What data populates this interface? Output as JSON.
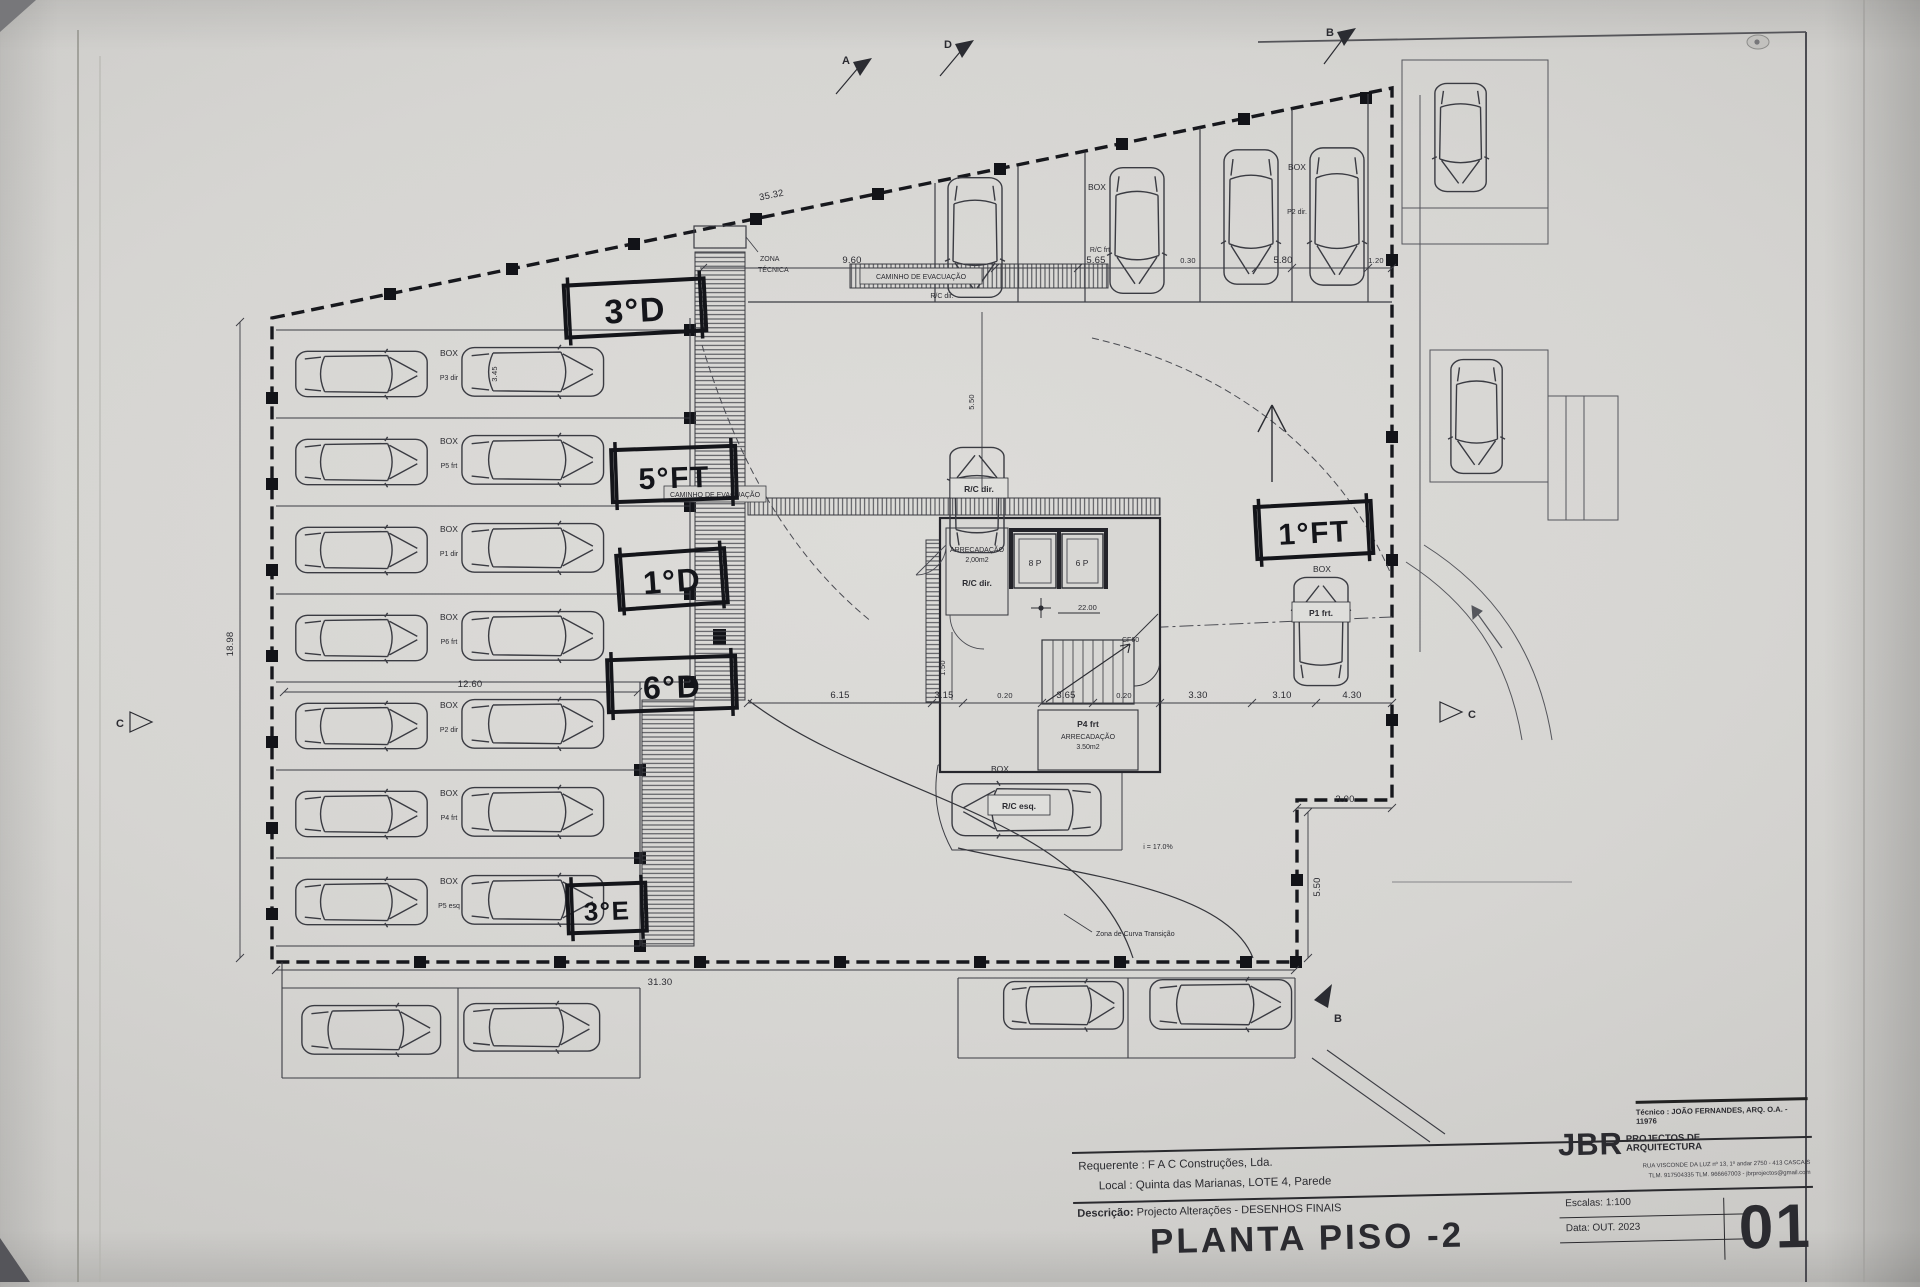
{
  "sheet": {
    "handwritten_labels": [
      "3°D",
      "5°FT",
      "1°D",
      "6°D",
      "3°E",
      "1°FT"
    ],
    "title_block": {
      "tecnico": "Técnico : JOÃO FERNANDES, ARQ.   O.A. - 11976",
      "requerente": "Requerente : F A C  Construções, Lda.",
      "local": "Local : Quinta das Marianas, LOTE 4, Parede",
      "descricao_label": "Descrição:",
      "descricao": "Projecto Alterações - DESENHOS FINAIS",
      "drawing_title": "PLANTA PISO -2",
      "firm_name": "JBR",
      "firm_type": "PROJECTOS DE ARQUITECTURA",
      "firm_address": "RUA VISCONDE DA LUZ nº 13, 1º andar  2750 - 413  CASCAIS",
      "firm_contact": "TLM. 917504335  TLM. 966667003 - jbrprojectos@gmail.com",
      "escalas": "Escalas:  1:100",
      "data": "Data: OUT.  2023",
      "sheet_number": "01"
    },
    "plan": {
      "box": "BOX",
      "rows": [
        "P3 dir",
        "P5 frt",
        "P1 dir",
        "P6 frt",
        "P2 dir",
        "P4 frt",
        "P5 esq"
      ],
      "caminho_evacuacao": "CAMINHO DE EVACUAÇÃO",
      "zona_tecnica_1": "ZONA",
      "zona_tecnica_2": "TÉCNICA",
      "rc_dir": "R/C dir.",
      "rc_esq": "R/C esq.",
      "rc_frt": "R/C frt",
      "p1_frt": "P1 frt.",
      "p2_dir": "P2 dir.",
      "p4_frt": "P4 frt",
      "arrecadacao": "ARRECADAÇÃO",
      "arrecadacao_area_1": "2,00m2",
      "arrecadacao_area_2": "3.50m2",
      "lift_8p": "8 P",
      "lift_6p": "6 P",
      "nivel": "22.00",
      "cf60": "CF60",
      "zona_curva": "Zona de Curva Transição",
      "inclinacao": "i = 17.0%",
      "sections": {
        "a": "A",
        "b": "B",
        "c": "C",
        "d": "D"
      },
      "dims": {
        "diag": "35.32",
        "w960": "9.60",
        "w565": "5.65",
        "w030": "0.30",
        "w580": "5.80",
        "w120": "1.20",
        "h1898": "18.98",
        "w1260": "12.60",
        "h345": "3.45",
        "w615": "6.15",
        "w315": "3.15",
        "w365": "3.65",
        "w330": "3.30",
        "w310": "3.10",
        "w430": "4.30",
        "w020a": "0.20",
        "w020b": "0.20",
        "w3130": "31.30",
        "w300": "3.00",
        "h550a": "5.50",
        "h550b": "5.50",
        "h150": "1.50"
      }
    }
  }
}
